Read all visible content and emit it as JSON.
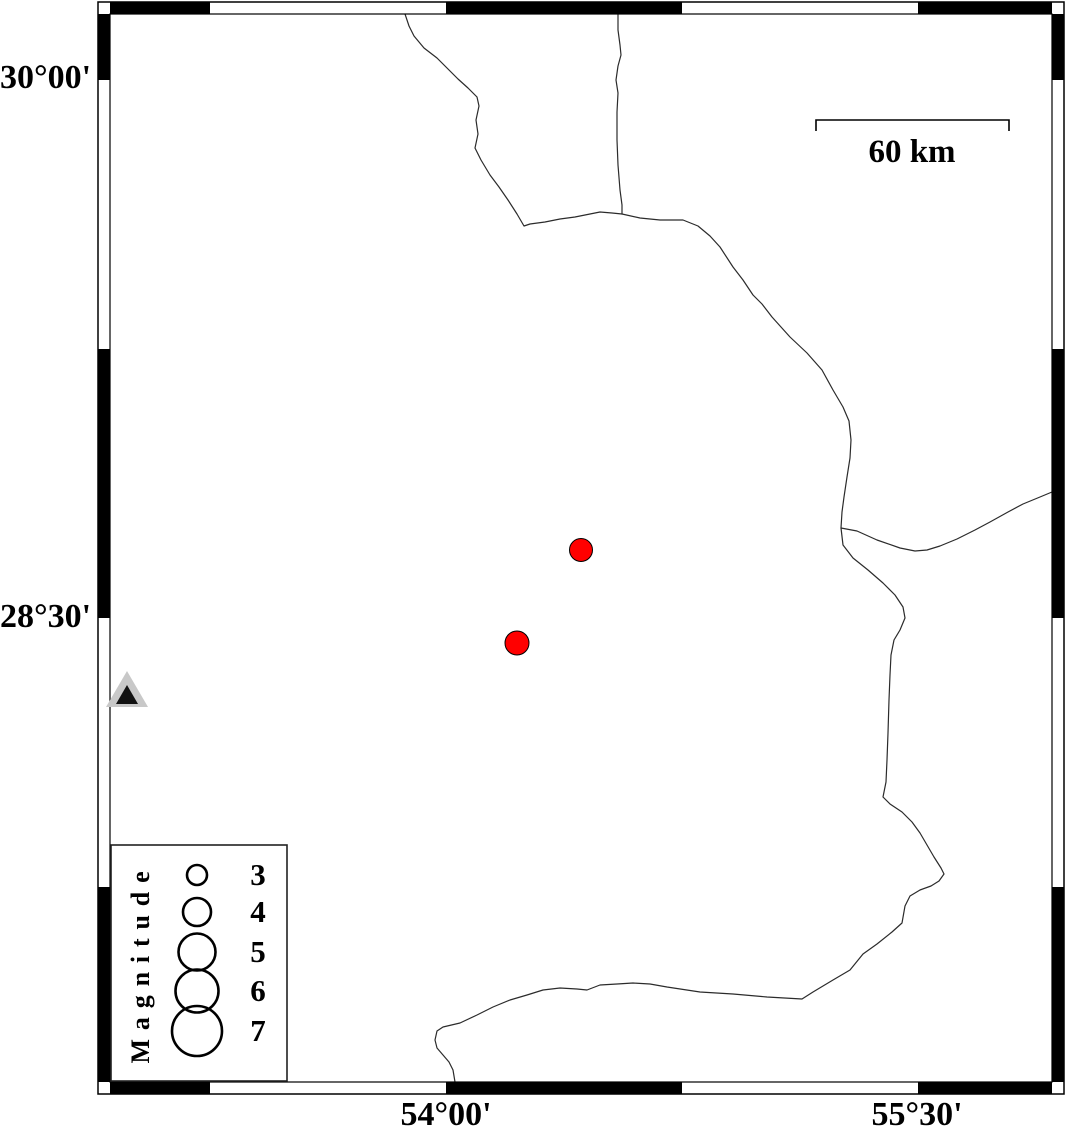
{
  "map": {
    "lat_labels": [
      {
        "text": "30°00'",
        "y": 78
      },
      {
        "text": "28°30'",
        "y": 617
      }
    ],
    "lon_labels": [
      {
        "text": "54°00'",
        "x": 446
      },
      {
        "text": "55°30'",
        "x": 917
      }
    ],
    "scale_bar": {
      "label": "60 km",
      "x1": 816,
      "x2": 1009,
      "y": 120,
      "tick": 11,
      "label_cx": 912,
      "label_cy": 152
    },
    "frame": {
      "outer": [
        98,
        2,
        1064,
        1094
      ],
      "inner": [
        110,
        14,
        1052,
        1082
      ],
      "black_x_segments": [
        [
          110,
          210
        ],
        [
          446,
          682
        ],
        [
          918,
          1052
        ]
      ],
      "black_y_segments": [
        [
          14,
          80
        ],
        [
          349,
          618
        ],
        [
          887,
          1082
        ]
      ],
      "color": "#000000"
    },
    "earthquakes": {
      "color": "#ff0000",
      "outline": "#000000",
      "points": [
        {
          "x": 581,
          "y": 550,
          "r": 11.5
        },
        {
          "x": 517,
          "y": 643,
          "r": 12
        }
      ]
    },
    "station": {
      "outer_triangle": [
        [
          127,
          671
        ],
        [
          106,
          707
        ],
        [
          148,
          707
        ]
      ],
      "outer_color": "#c8c8c8",
      "inner_triangle": [
        [
          127,
          685
        ],
        [
          116,
          704
        ],
        [
          138,
          704
        ]
      ],
      "inner_color": "#111111"
    },
    "border_line_color": "#2b2b2b",
    "border_lines": [
      [
        [
          405,
          14
        ],
        [
          409,
          26
        ],
        [
          414,
          36
        ],
        [
          424,
          48
        ],
        [
          437,
          58
        ],
        [
          447,
          68
        ],
        [
          458,
          79
        ],
        [
          468,
          88
        ],
        [
          477,
          97
        ],
        [
          479,
          106
        ],
        [
          476,
          120
        ],
        [
          478,
          134
        ],
        [
          475,
          148
        ],
        [
          481,
          160
        ],
        [
          490,
          175
        ],
        [
          499,
          187
        ],
        [
          508,
          200
        ],
        [
          517,
          214
        ],
        [
          524,
          226
        ],
        [
          530,
          224
        ],
        [
          545,
          222
        ],
        [
          560,
          219
        ],
        [
          575,
          217
        ],
        [
          590,
          214
        ],
        [
          600,
          212
        ],
        [
          612,
          213
        ],
        [
          622,
          214
        ],
        [
          640,
          218
        ],
        [
          660,
          220
        ],
        [
          683,
          220
        ],
        [
          698,
          226
        ],
        [
          710,
          236
        ],
        [
          720,
          247
        ],
        [
          733,
          267
        ],
        [
          743,
          280
        ],
        [
          753,
          295
        ],
        [
          762,
          304
        ],
        [
          772,
          317
        ],
        [
          790,
          337
        ],
        [
          807,
          353
        ],
        [
          822,
          370
        ],
        [
          833,
          390
        ],
        [
          843,
          407
        ],
        [
          849,
          421
        ],
        [
          851,
          440
        ],
        [
          850,
          458
        ],
        [
          847,
          477
        ],
        [
          844,
          497
        ],
        [
          842,
          512
        ],
        [
          841,
          528
        ],
        [
          843,
          545
        ],
        [
          853,
          558
        ],
        [
          868,
          570
        ],
        [
          883,
          583
        ],
        [
          895,
          595
        ],
        [
          903,
          607
        ],
        [
          905,
          618
        ],
        [
          900,
          630
        ],
        [
          894,
          640
        ],
        [
          891,
          655
        ],
        [
          890,
          675
        ],
        [
          889,
          700
        ],
        [
          888,
          733
        ],
        [
          887,
          760
        ],
        [
          886,
          782
        ],
        [
          883,
          797
        ],
        [
          890,
          804
        ],
        [
          902,
          812
        ],
        [
          912,
          822
        ],
        [
          920,
          833
        ],
        [
          927,
          845
        ],
        [
          934,
          857
        ],
        [
          941,
          868
        ],
        [
          944,
          874
        ],
        [
          939,
          881
        ],
        [
          931,
          886
        ],
        [
          920,
          890
        ],
        [
          910,
          896
        ],
        [
          905,
          906
        ],
        [
          902,
          923
        ],
        [
          892,
          932
        ],
        [
          877,
          944
        ],
        [
          863,
          954
        ],
        [
          850,
          970
        ],
        [
          833,
          980
        ],
        [
          813,
          992
        ],
        [
          802,
          999
        ],
        [
          767,
          997
        ],
        [
          733,
          994
        ],
        [
          700,
          992
        ],
        [
          667,
          987
        ],
        [
          650,
          984
        ],
        [
          633,
          983
        ],
        [
          617,
          984
        ],
        [
          600,
          985
        ],
        [
          587,
          990
        ],
        [
          577,
          989
        ],
        [
          560,
          988
        ],
        [
          543,
          990
        ],
        [
          527,
          995
        ],
        [
          510,
          1000
        ],
        [
          493,
          1007
        ],
        [
          477,
          1015
        ],
        [
          460,
          1023
        ],
        [
          443,
          1027
        ],
        [
          437,
          1031
        ],
        [
          435,
          1040
        ],
        [
          437,
          1048
        ],
        [
          443,
          1055
        ],
        [
          449,
          1062
        ],
        [
          453,
          1070
        ],
        [
          455,
          1082
        ]
      ],
      [
        [
          618,
          14
        ],
        [
          618,
          30
        ],
        [
          620,
          45
        ],
        [
          621,
          55
        ],
        [
          618,
          66
        ],
        [
          616,
          80
        ],
        [
          618,
          93
        ],
        [
          617,
          112
        ],
        [
          617,
          140
        ],
        [
          618,
          165
        ],
        [
          620,
          190
        ],
        [
          622,
          205
        ],
        [
          622,
          214
        ]
      ],
      [
        [
          841,
          528
        ],
        [
          857,
          531
        ],
        [
          877,
          540
        ],
        [
          900,
          548
        ],
        [
          915,
          551
        ],
        [
          927,
          550
        ],
        [
          940,
          546
        ],
        [
          957,
          539
        ],
        [
          975,
          530
        ],
        [
          990,
          522
        ],
        [
          1008,
          512
        ],
        [
          1023,
          504
        ],
        [
          1040,
          497
        ],
        [
          1052,
          492
        ]
      ]
    ]
  },
  "legend": {
    "title": "Magnitude",
    "title_cx": 141,
    "title_cy": 963,
    "box": [
      111,
      845,
      287,
      1081
    ],
    "circle_cx": 197,
    "label_cx": 258,
    "items": [
      {
        "label": "3",
        "cy": 875,
        "r": 10
      },
      {
        "label": "4",
        "cy": 912,
        "r": 14
      },
      {
        "label": "5",
        "cy": 952,
        "r": 18.5
      },
      {
        "label": "6",
        "cy": 991,
        "r": 21.5
      },
      {
        "label": "7",
        "cy": 1031,
        "r": 25
      }
    ]
  }
}
